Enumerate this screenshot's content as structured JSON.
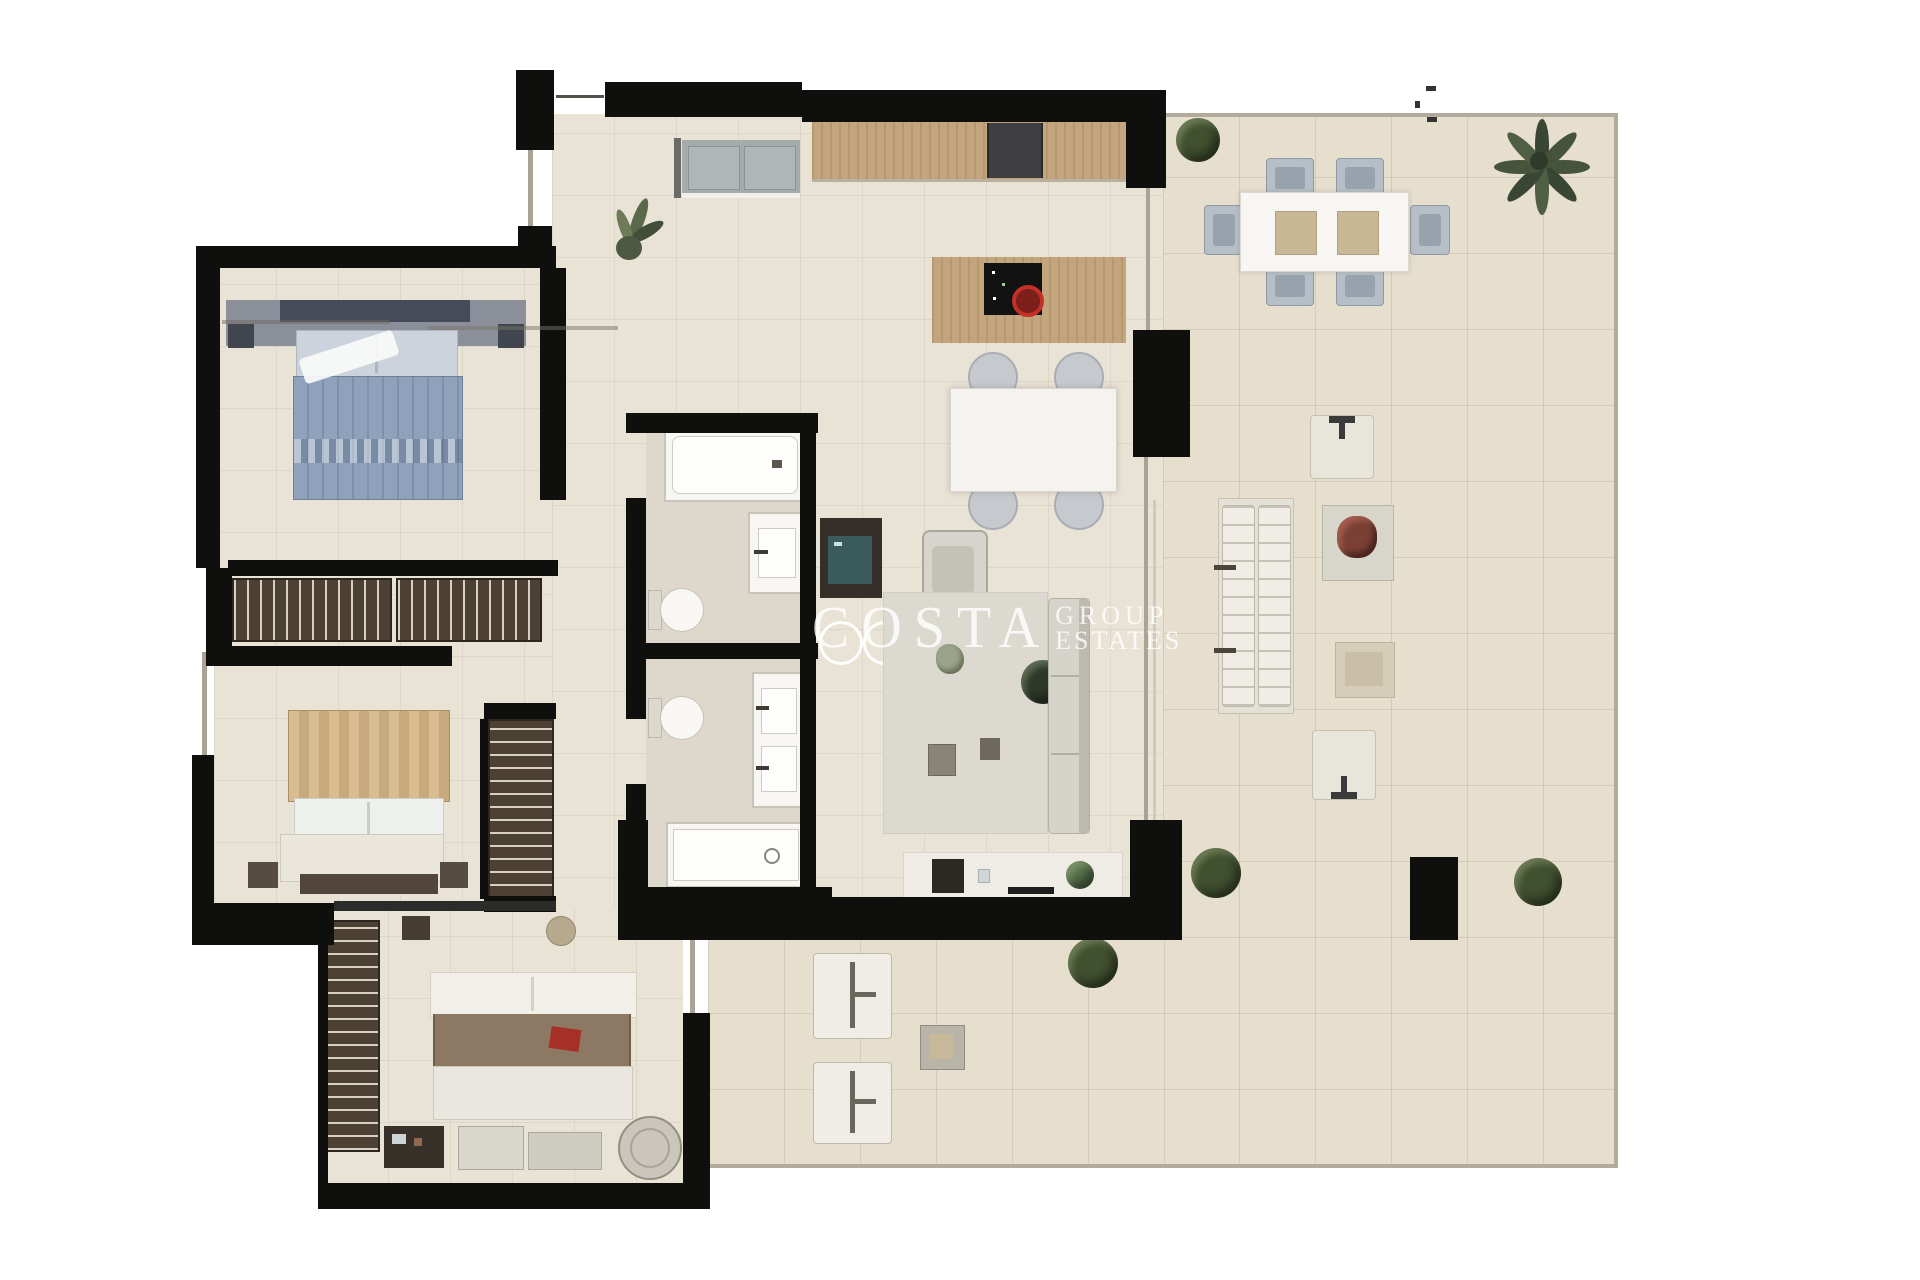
{
  "artwork": {
    "type": "apartment floor plan (top-down 3D render)",
    "background": "#ffffff",
    "orientation": "interior left / large terrace right"
  },
  "watermark": {
    "word_large": "COSTA",
    "word_top": "GROUP",
    "word_bottom": "ESTATES",
    "style": "translucent white serif capitals"
  },
  "palette": {
    "walls": "#0f0f0e",
    "interior_floor": "#e9e3d6",
    "terrace_floor": "#e6dfce",
    "bath_floor": "#ddd8cb",
    "wood_counter": "#c3a57e",
    "wardrobe_brown": "#4d4134",
    "bed_blue": "#8ea2bb",
    "bed_tan": "#d9bd92",
    "bed_master_duvet": "#8d7963",
    "accent_red": "#b22c24",
    "plant_green": "#41502f",
    "fixtures_white": "#f7f6f2",
    "outdoor_chair_gray": "#b6bfc8",
    "terrace_border_line": "#b2ab9b"
  },
  "rooms": [
    {
      "id": "entrance-hall",
      "features": [
        "entry-door",
        "potted-plant",
        "laundry-appliances"
      ]
    },
    {
      "id": "kitchen",
      "features": [
        "wall-counter",
        "dark-range",
        "island",
        "black-cooktop",
        "red-pot"
      ]
    },
    {
      "id": "dining-area",
      "features": [
        "white-table",
        "4-round-chairs"
      ]
    },
    {
      "id": "living-room",
      "features": [
        "tv-cabinet",
        "armchair",
        "area-rug",
        "coffee-tables",
        "sofa",
        "plant-stand",
        "media-sideboard",
        "2-ceiling-lamps"
      ]
    },
    {
      "id": "bathroom-1",
      "features": [
        "bathtub",
        "vanity-sink",
        "toilet"
      ]
    },
    {
      "id": "bathroom-2",
      "features": [
        "shower",
        "double-vanity",
        "toilet"
      ]
    },
    {
      "id": "hallway",
      "features": [
        "double-wardrobe-row"
      ]
    },
    {
      "id": "bedroom-1",
      "features": [
        "double-bed-blue",
        "2-nightstands",
        "white-throw"
      ]
    },
    {
      "id": "bedroom-2",
      "features": [
        "double-bed-tan-canopy",
        "2-nightstands",
        "foot-bench",
        "tall-wardrobe"
      ]
    },
    {
      "id": "master-bedroom",
      "features": [
        "double-bed-brown",
        "red-cushion",
        "dresser",
        "round-chair",
        "2-foot-benches",
        "tall-wardrobe",
        "pouf",
        "small-bench"
      ]
    },
    {
      "id": "terrace",
      "features": [
        "outdoor-dining-table",
        "6-outdoor-chairs",
        "double-sun-lounger",
        "lounge-chair-pair",
        "flower-table",
        "ottoman",
        "2-sun-loungers-south",
        "side-table",
        "palm-tree",
        "4-bushes",
        "black-pillar"
      ]
    }
  ]
}
